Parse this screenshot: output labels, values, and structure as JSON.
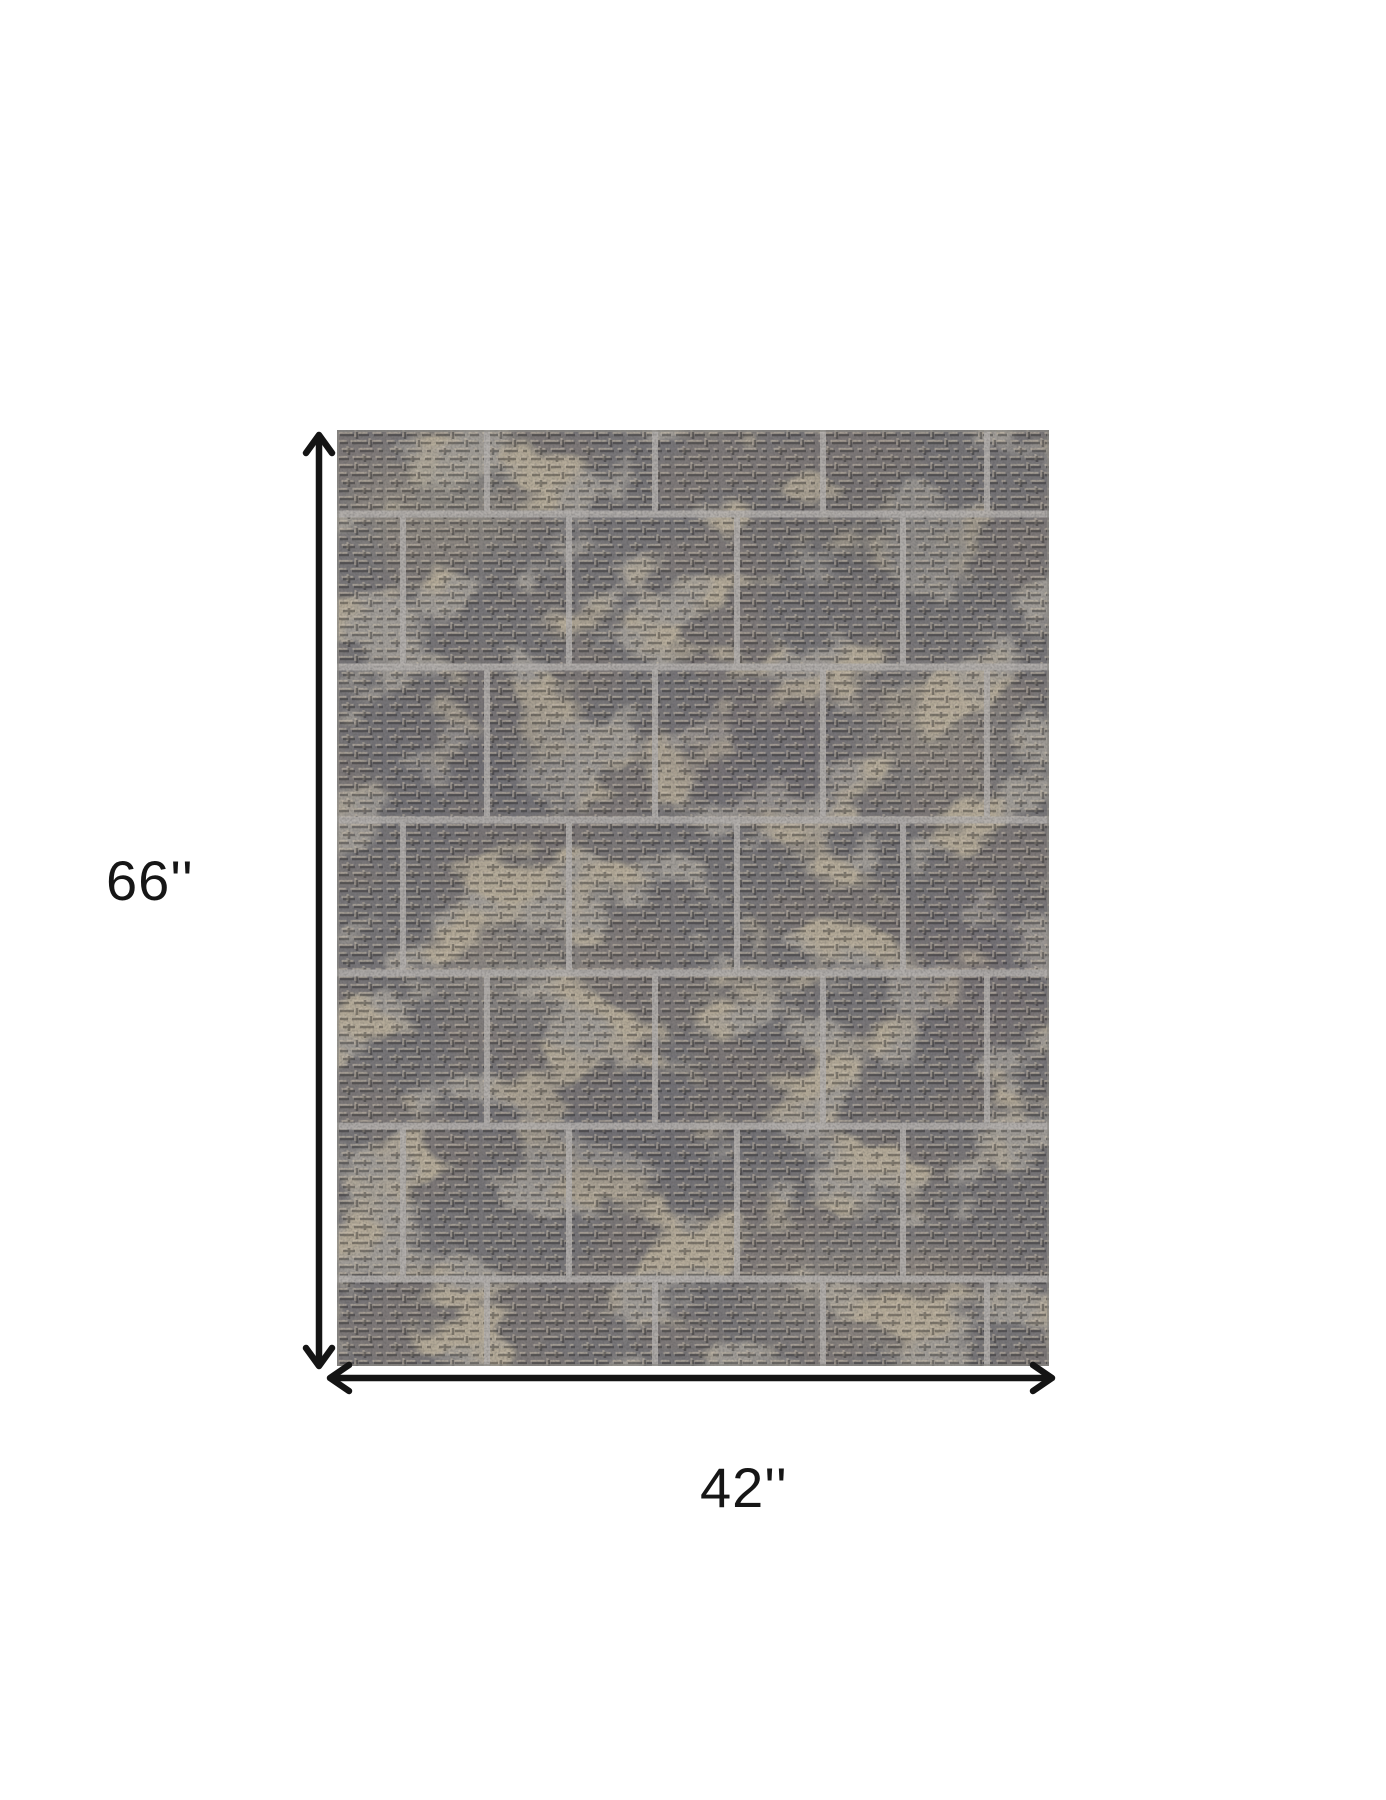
{
  "diagram": {
    "type": "product-dimension-diagram",
    "product": "textured-patchwork-area-rug",
    "height_label": "66''",
    "width_label": "42''"
  },
  "icons": {
    "height_arrow": "double-headed-vertical-arrow-icon",
    "width_arrow": "double-headed-horizontal-arrow-icon"
  },
  "colors": {
    "background": "#ffffff",
    "dimension_lines": "#141414",
    "label_text": "#161616",
    "rug_base": "#a19d98",
    "rug_dark_patch": "#67666c",
    "rug_light_patch": "#b9b09d",
    "rug_groove": "#5e5d60",
    "rug_highlight": "#c6bcaa",
    "rug_grid_line": "#b5b2af",
    "rug_edge": "#8a8884"
  }
}
